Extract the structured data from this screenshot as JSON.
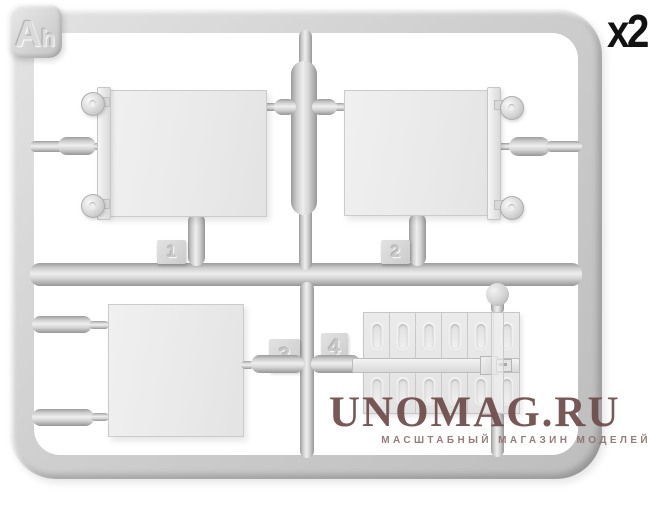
{
  "sprue": {
    "label": "Ah",
    "quantity": "x2",
    "part_numbers": [
      "1",
      "2",
      "3",
      "4"
    ],
    "plastic_color": "#d9d9d9"
  },
  "watermark": {
    "title": "UNOMAG.RU",
    "subtitle": "МАСШТАБНЫЙ МАГАЗИН МОДЕЛЕЙ",
    "color": "#6d4b49"
  },
  "background_color": "#ffffff",
  "quantity_text_color": "#121212"
}
